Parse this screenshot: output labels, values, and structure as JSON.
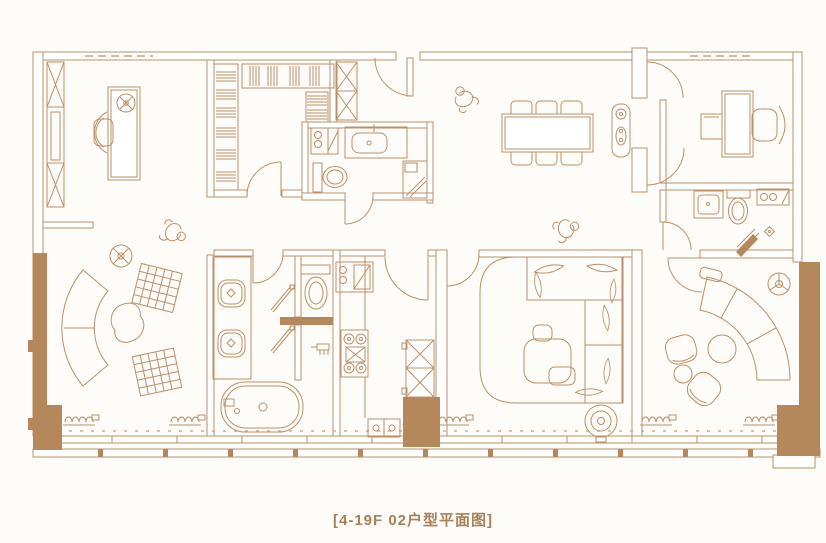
{
  "caption": {
    "text": "[4-19F 02户型平面图]"
  },
  "palette": {
    "line": "#bb9068",
    "line_soft": "#d2af88",
    "wall_fill": "#b5885c",
    "background": "#fdfcf8",
    "caption_color": "#a8805a"
  },
  "legend": {
    "symbols": [
      "entry-door",
      "walk-in-closet-hangers",
      "wardrobe",
      "study-desk",
      "dining-table-six-chairs",
      "bathtub",
      "double-vanity",
      "toilet",
      "shower",
      "washer",
      "kitchen-stove",
      "kitchen-sink",
      "refrigerator",
      "bed-with-pillows",
      "curved-sofa",
      "coffee-table",
      "rug",
      "ceiling-fan",
      "floor-to-ceiling-windows",
      "human-figure"
    ]
  }
}
